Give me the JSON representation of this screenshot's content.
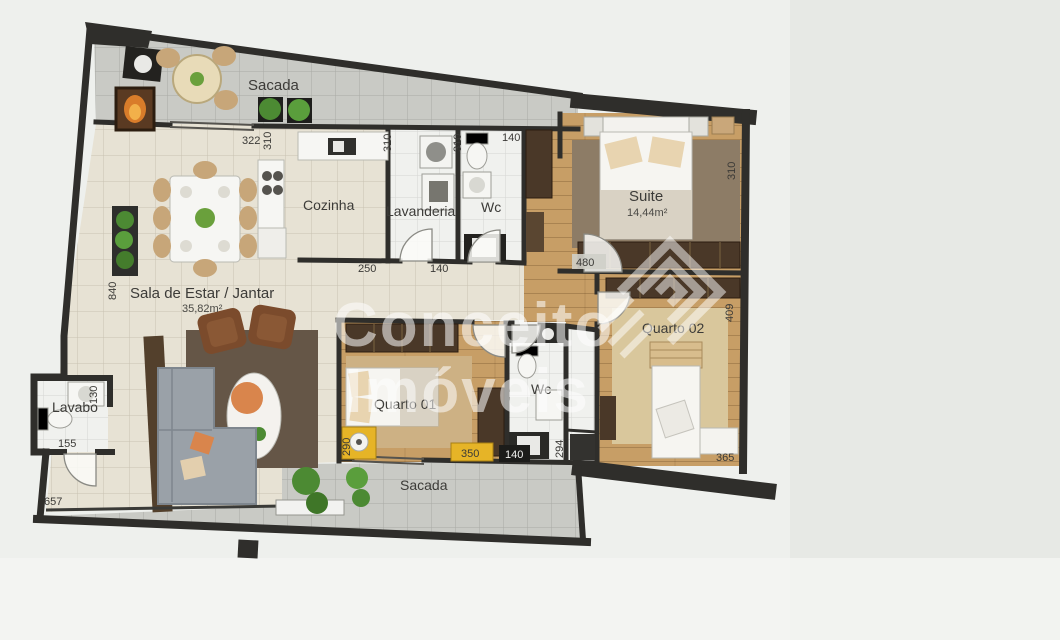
{
  "watermark": {
    "line1": "Conceito",
    "line2": "Imóveis"
  },
  "rooms": {
    "sacada_top": {
      "label": "Sacada"
    },
    "cozinha": {
      "label": "Cozinha"
    },
    "lavanderia": {
      "label": "Lavanderia"
    },
    "wc_top": {
      "label": "Wc"
    },
    "suite": {
      "label": "Suite",
      "area": "14,44m²"
    },
    "quarto02": {
      "label": "Quarto 02"
    },
    "sala": {
      "label": "Sala de Estar / Jantar",
      "area": "35,82m²"
    },
    "lavabo": {
      "label": "Lavabo"
    },
    "quarto01": {
      "label": "Quarto 01"
    },
    "wc_bottom": {
      "label": "Wc"
    },
    "sacada_bottom": {
      "label": "Sacada"
    }
  },
  "dimensions": {
    "sacada_top_width": "322",
    "cozinha_height": "310",
    "cozinha_width": "250",
    "lavanderia_height": "310",
    "lavanderia_width": "140",
    "wc_top_height": "310",
    "wc_top_width": "140",
    "suite_door": "480",
    "suite_height": "310",
    "quarto02_height": "409",
    "quarto02_width": "365",
    "quarto01_height": "290",
    "quarto01_width": "350",
    "wc_bottom_width": "140",
    "wc_bottom_height": "294",
    "sala_height": "840",
    "sacada_bottom_length": "657",
    "lavabo_width": "155",
    "lavabo_height": "130"
  },
  "colors": {
    "wall": "#2f2e2b",
    "wood_floor": "#c79e66",
    "tile_beige": "#e7e2d4",
    "tile_gray": "#c9cac5",
    "tile_white": "#f0f1ee",
    "accent_yellow": "#e6b427",
    "plant_green": "#4c8a33",
    "dark_wood": "#4a3828",
    "watermark_white": "#ffffff"
  }
}
